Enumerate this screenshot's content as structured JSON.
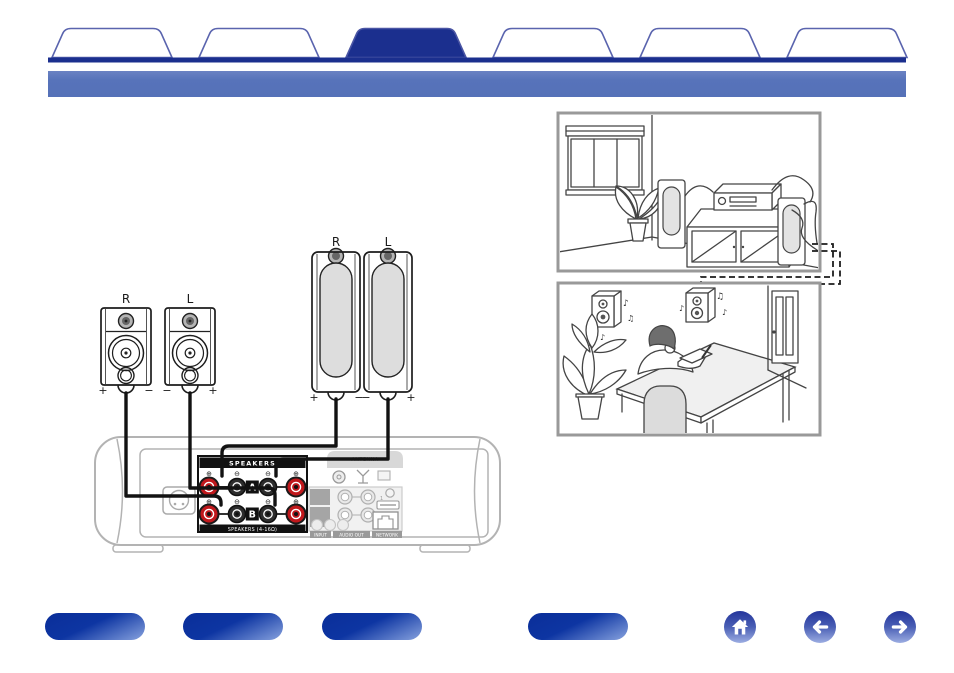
{
  "tabs": {
    "count": 6,
    "active_position": 3
  },
  "diagram": {
    "speakers": {
      "bookshelf_right": {
        "label": "R",
        "left_sign": "+",
        "right_sign": "−"
      },
      "bookshelf_left": {
        "label": "L",
        "left_sign": "−",
        "right_sign": "+"
      },
      "tower_right": {
        "label": "R",
        "left_sign": "+",
        "right_sign": "−"
      },
      "tower_left": {
        "label": "L",
        "left_sign": "−",
        "right_sign": "+"
      }
    },
    "amplifier": {
      "speakers_block": {
        "title": "SPEAKERS",
        "row_a_label": "A",
        "row_b_label": "B",
        "terminal_signs": [
          "⊕",
          "⊖",
          "⊖",
          "⊕"
        ],
        "bottom_label": "SPEAKERS (4-16Ω)"
      },
      "antenna_label": "ANTENNA",
      "jack_numbers": [
        "1",
        "2"
      ],
      "input_label": "INPUT",
      "audio_out_label": "AUDIO OUT",
      "network_label": "NETWORK"
    }
  },
  "illustrations": {
    "study_notes": [
      "♪",
      "♫",
      "♪",
      "♫",
      "♪",
      "♪"
    ]
  },
  "colors": {
    "accent_navy": "#1b2f8e",
    "tab_border": "#5a64ae",
    "header_blue": "#5773ba",
    "terminal_red": "#c0181c",
    "button_dark": "#0b339c",
    "button_light": "#8ca8e0"
  }
}
